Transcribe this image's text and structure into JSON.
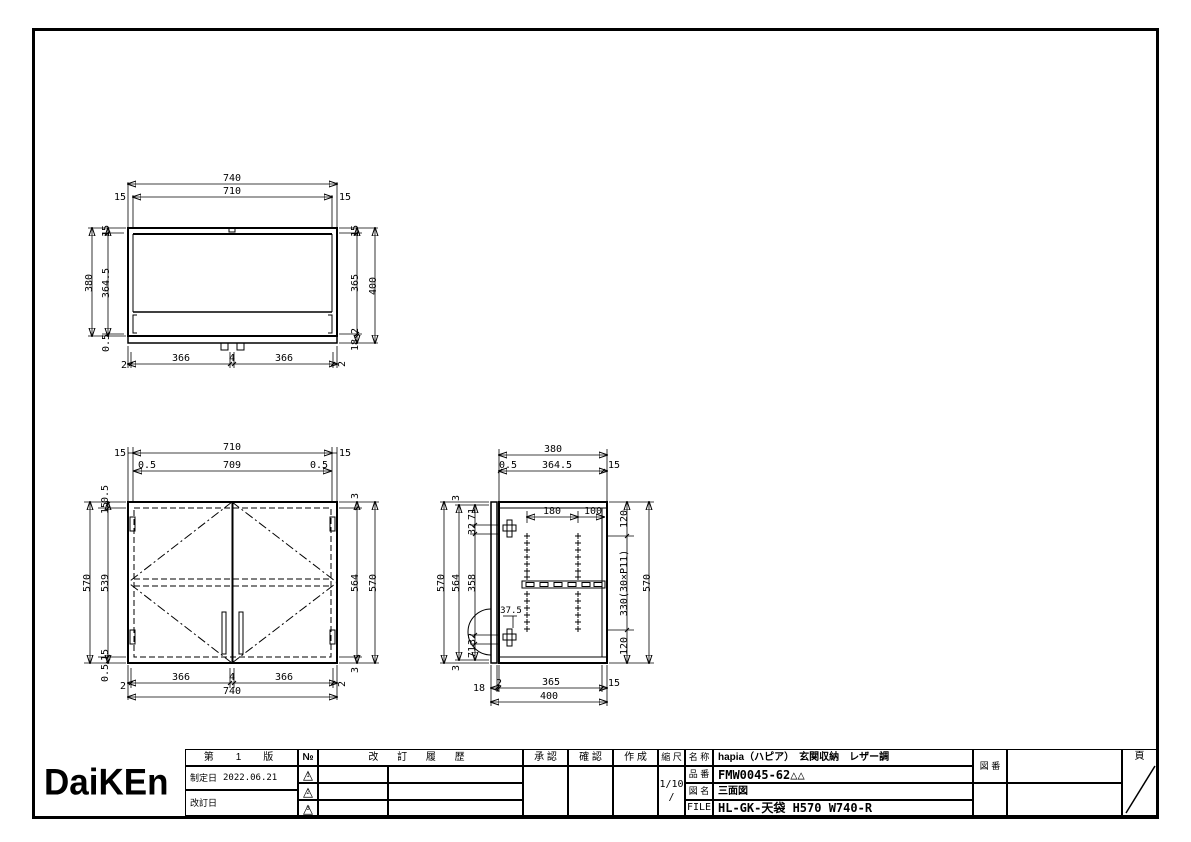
{
  "page": {
    "background": "#ffffff",
    "line_color": "#000000"
  },
  "views": {
    "top_view": {
      "dims": {
        "overall_width": "740",
        "inner_width": "710",
        "left_margin": "15",
        "right_margin": "15",
        "left_outer": "380",
        "left_col": [
          "15",
          "364.5",
          "0.5"
        ],
        "right_col": [
          "15",
          "365",
          "2",
          "18"
        ],
        "right_outer": "400",
        "bottom": [
          "2",
          "366",
          "4",
          "366",
          "2"
        ]
      }
    },
    "front_view": {
      "dims": {
        "top_row1": [
          "15",
          "710",
          "15"
        ],
        "top_row2": [
          "0.5",
          "709",
          "0.5"
        ],
        "left_outer": "570",
        "left_col": [
          "0.5",
          "15",
          "539",
          "15",
          "0.5"
        ],
        "right_col": [
          "3",
          "564",
          "3"
        ],
        "right_outer": "570",
        "bottom_row1": [
          "2",
          "366",
          "4",
          "366",
          "2"
        ],
        "bottom_row2": "740"
      }
    },
    "side_view": {
      "dims": {
        "top_row1": "380",
        "top_row2": [
          "0.5",
          "364.5",
          "15"
        ],
        "left_outer": "570",
        "left_mid": [
          "3",
          "564",
          "3"
        ],
        "left_col": [
          "71",
          "32",
          "358",
          "32",
          "71"
        ],
        "right_col": [
          "120",
          "330(30×P11)",
          "120"
        ],
        "right_outer": "570",
        "holes_row": [
          "180",
          "100"
        ],
        "hinge_offset": "37.5",
        "bottom_row1": [
          "18",
          "2",
          "365",
          "15"
        ],
        "bottom_row2": "400"
      }
    }
  },
  "title_block": {
    "logo": "DaiKEn",
    "edition": "第　1　版",
    "established_label": "制定日",
    "established_date": "2022.06.21",
    "revised_label": "改訂日",
    "no_header": "№",
    "revision_triangle": "△",
    "revision_marks": [
      "1",
      "2",
      "3"
    ],
    "history_header": "改 訂 履 歴",
    "approval_label": "承 認",
    "check_label": "確 認",
    "author_label": "作 成",
    "scale_label": "縮 尺",
    "scale_value": "1/10",
    "scale_value2": "/",
    "name_label": "名 称",
    "name_value": "hapia（ハピア）　玄関収納　レザー調",
    "part_label": "品 番",
    "part_value": "FMW0045-62△△",
    "drawing_label": "図 名",
    "drawing_value": "三面図",
    "file_label": "FILE",
    "file_value": "HL-GK-天袋 H570 W740-R",
    "fig_no_label": "図 番",
    "page_label": "頁"
  }
}
